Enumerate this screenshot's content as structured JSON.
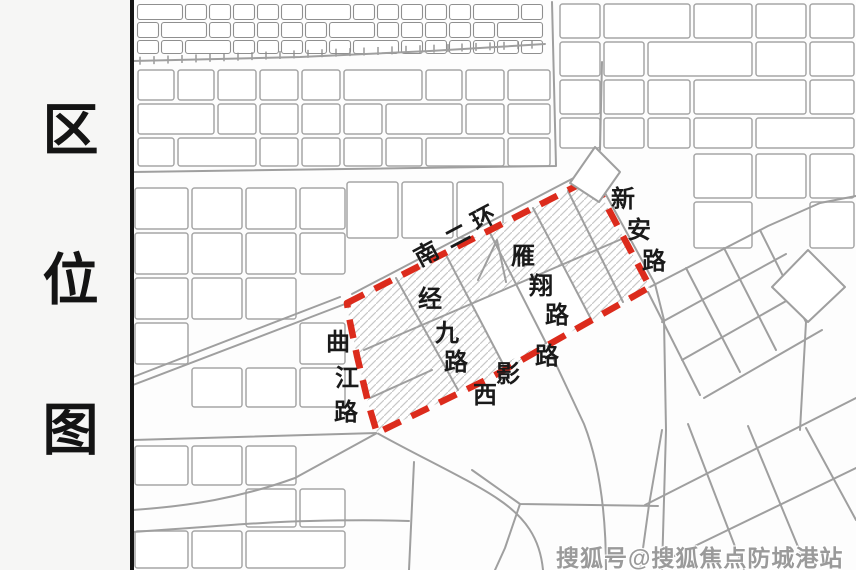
{
  "sidebar": {
    "title": "区位图"
  },
  "map": {
    "boundary_color": "#dc2b1c",
    "road_labels": [
      {
        "id": "nanerhuan",
        "text": "南二环"
      },
      {
        "id": "xinan",
        "text": "新安路"
      },
      {
        "id": "yanxiang",
        "text": "雁翔路"
      },
      {
        "id": "jingjiu",
        "text": "经九路"
      },
      {
        "id": "qujiang",
        "text": "曲江路"
      },
      {
        "id": "xiying",
        "text": "西影路"
      }
    ]
  },
  "watermark": {
    "text": "搜狐号@搜狐焦点防城港站"
  }
}
